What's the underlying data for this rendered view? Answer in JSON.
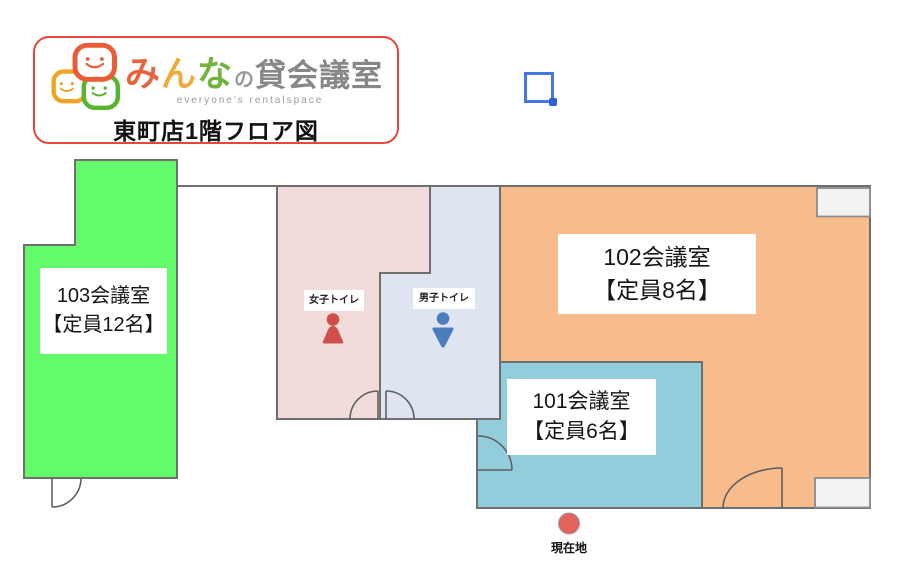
{
  "header": {
    "logo": {
      "brand_parts": [
        {
          "text": "み",
          "color": "#e8623c"
        },
        {
          "text": "ん",
          "color": "#f2a93b"
        },
        {
          "text": "な",
          "color": "#72b33e"
        },
        {
          "text": "の",
          "color": "#9a9a9a"
        },
        {
          "text": "貸会議室",
          "color": "#878787"
        }
      ],
      "subtitle": "everyone's rentalspace",
      "bubble_colors": [
        "#f0a426",
        "#55b52e",
        "#e95c35"
      ]
    },
    "title": "東町店1階フロア図",
    "border_color": "#e8453c"
  },
  "floorplan": {
    "rooms": [
      {
        "name": "103会議室",
        "capacity": "【定員12名】",
        "color": "#63fb6a"
      },
      {
        "name": "102会議室",
        "capacity": "【定員8名】",
        "color": "#f8bc8c"
      },
      {
        "name": "101会議室",
        "capacity": "【定員6名】",
        "color": "#92cddc"
      }
    ],
    "toilets": [
      {
        "label": "女子トイレ",
        "area_color": "#f2dcdb",
        "icon_color": "#d14f4a"
      },
      {
        "label": "男子トイレ",
        "area_color": "#dee5f1",
        "icon_color": "#4a7ebf"
      }
    ],
    "marker": {
      "label": "現在地",
      "color": "#e4635c"
    },
    "wall_color": "#6f6f6f",
    "window_color": "#f2f2f2"
  },
  "selection_square": {
    "color": "#4479e4",
    "handle_color": "#2a5fd9"
  }
}
